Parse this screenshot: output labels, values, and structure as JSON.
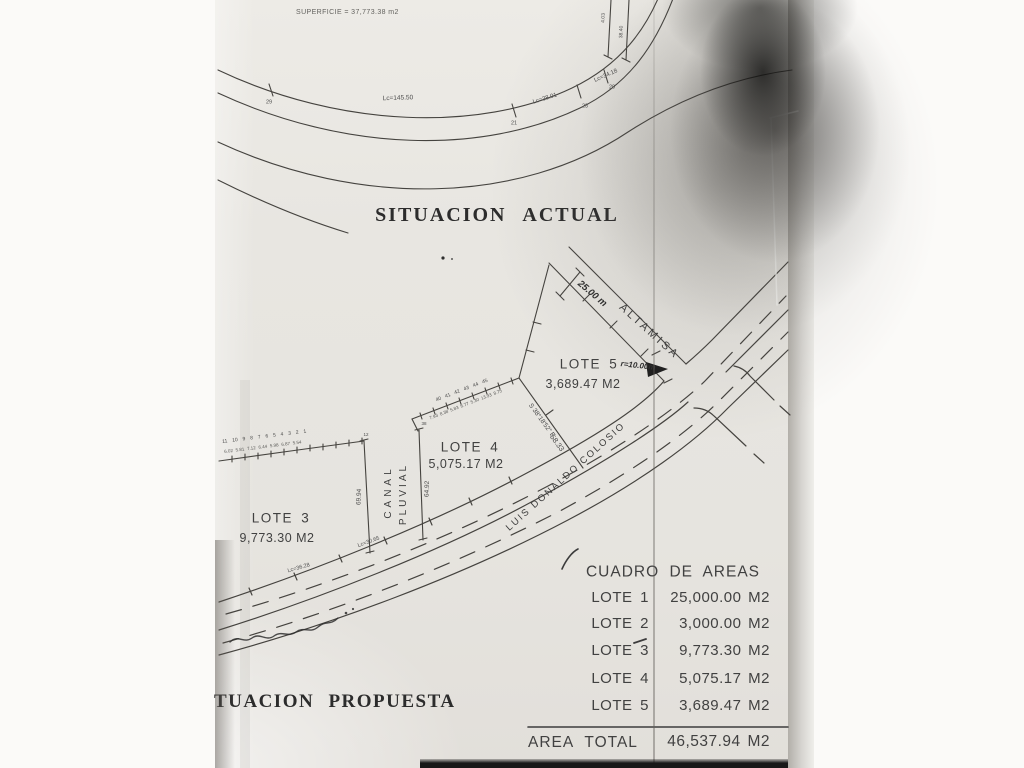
{
  "document": {
    "superficie_note": "SUPERFICIE = 37,773.38 m2",
    "title_actual": "SITUACION ACTUAL",
    "title_propuesta": "SITUACION PROPUESTA"
  },
  "streets": {
    "altamisa": "ALTAMISA",
    "colosio": "LUIS DONALDO COLOSIO",
    "canal_line1": "CANAL",
    "canal_line2": "PLUVIAL"
  },
  "lots": {
    "lote3": {
      "name": "LOTE 3",
      "area": "9,773.30 M2"
    },
    "lote4": {
      "name": "LOTE 4",
      "area": "5,075.17 M2"
    },
    "lote5": {
      "name": "LOTE 5",
      "area": "3,689.47 M2",
      "radius_note": "r=10.00m"
    }
  },
  "annotations": {
    "width_dim": "25.00 m",
    "bearing": "S 38°18'52\" E",
    "bearing_dist": "58.33",
    "canal_left_len": "69.94",
    "canal_right_len": "64.92",
    "lc_top_mid": "Lc=145.50",
    "lc_top_r1": "Lc=38.01",
    "lc_top_r2": "Lc=34.18",
    "lc_bottom_1": "Lc=36.28",
    "lc_bottom_2": "Lc=30.65",
    "pt_top_left": "29",
    "pt_top_mid": "21",
    "pt_top_r1": "23",
    "pt_top_r2": "20",
    "side_dim_1": "4.03",
    "side_dim_2": "38.40",
    "canal_pt_tl": "12",
    "canal_pt_tr": "38",
    "lote3_points": "11 10 9 8 7 6 5 4 3 2 1",
    "lote3_dists": "6.02 5.81 7.12 6.44 5.98 6.87 5.54",
    "lote4_points": "40 41 42 43 44 45",
    "lote4_dists": "7.93 8.38 5.83 8.77 5.30 13.93 8.75"
  },
  "table": {
    "title": "CUADRO DE AREAS",
    "rows": [
      {
        "label": "LOTE 1",
        "value": "25,000.00 M2"
      },
      {
        "label": "LOTE 2",
        "value": "3,000.00 M2"
      },
      {
        "label": "LOTE 3",
        "value": "9,773.30 M2"
      },
      {
        "label": "LOTE 4",
        "value": "5,075.17 M2"
      },
      {
        "label": "LOTE 5",
        "value": "3,689.47 M2"
      }
    ],
    "total_label": "AREA TOTAL",
    "total_value": "46,537.94 M2"
  }
}
